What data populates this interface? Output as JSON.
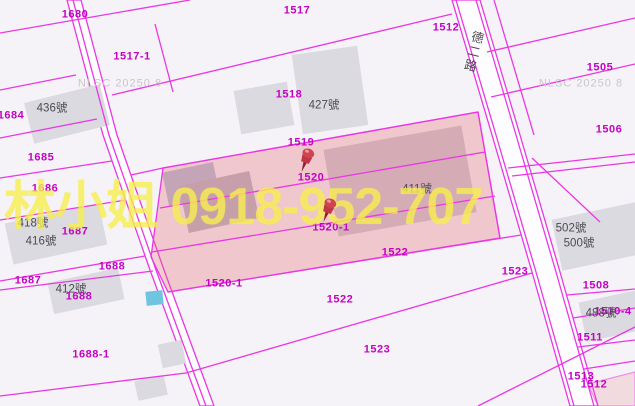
{
  "map": {
    "watermark": {
      "text": "林小姐 0918-952-707",
      "color": "#f8ee50"
    },
    "road_name": {
      "text": "德二路",
      "x": 466,
      "y": 30
    },
    "colors": {
      "background": "#f5f3f7",
      "line": "#ea37e4",
      "road_fill": "#fdfdff",
      "selected_fill": "rgba(228,105,115,0.32)",
      "parcel_label": "#c303c3",
      "building_label": "#4b4b52",
      "building_fill": "#dbdae0",
      "water_fill": "#6fc4e0",
      "pin_red": "#c03744",
      "nlsc_gray": "#cbc5cd",
      "watermark_yellow": "#f8ee50"
    },
    "nlsc_watermarks": [
      {
        "text": "NLSC 20250 8",
        "x": 120,
        "y": 84
      },
      {
        "text": "NLSC 20250 8",
        "x": 581,
        "y": 84
      }
    ],
    "parcel_labels": [
      {
        "text": "1680",
        "x": 75,
        "y": 15
      },
      {
        "text": "1517",
        "x": 297,
        "y": 11
      },
      {
        "text": "1512",
        "x": 446,
        "y": 28
      },
      {
        "text": "1517-1",
        "x": 132,
        "y": 57
      },
      {
        "text": "1505",
        "x": 600,
        "y": 68
      },
      {
        "text": "1518",
        "x": 289,
        "y": 95
      },
      {
        "text": "1684",
        "x": 11,
        "y": 116
      },
      {
        "text": "1506",
        "x": 609,
        "y": 130
      },
      {
        "text": "1519",
        "x": 301,
        "y": 143
      },
      {
        "text": "1685",
        "x": 41,
        "y": 158
      },
      {
        "text": "1520",
        "x": 311,
        "y": 178
      },
      {
        "text": "1686",
        "x": 45,
        "y": 189
      },
      {
        "text": "1520-1",
        "x": 331,
        "y": 228
      },
      {
        "text": "1687",
        "x": 75,
        "y": 232
      },
      {
        "text": "1522",
        "x": 395,
        "y": 253
      },
      {
        "text": "1688",
        "x": 112,
        "y": 267
      },
      {
        "text": "1523",
        "x": 515,
        "y": 272
      },
      {
        "text": "1687",
        "x": 28,
        "y": 281
      },
      {
        "text": "1520-1",
        "x": 224,
        "y": 284
      },
      {
        "text": "1508",
        "x": 596,
        "y": 286
      },
      {
        "text": "1688",
        "x": 79,
        "y": 297
      },
      {
        "text": "1522",
        "x": 340,
        "y": 300
      },
      {
        "text": "1510-4",
        "x": 613,
        "y": 312
      },
      {
        "text": "1511",
        "x": 590,
        "y": 338
      },
      {
        "text": "1523",
        "x": 377,
        "y": 350
      },
      {
        "text": "1688-1",
        "x": 91,
        "y": 355
      },
      {
        "text": "1513",
        "x": 581,
        "y": 377
      },
      {
        "text": "1512",
        "x": 594,
        "y": 385
      }
    ],
    "building_labels": [
      {
        "text": "436號",
        "x": 52,
        "y": 109
      },
      {
        "text": "427號",
        "x": 324,
        "y": 106
      },
      {
        "text": "411號",
        "x": 417,
        "y": 190
      },
      {
        "text": "418號",
        "x": 33,
        "y": 224
      },
      {
        "text": "416號",
        "x": 41,
        "y": 242
      },
      {
        "text": "502號",
        "x": 571,
        "y": 229
      },
      {
        "text": "500號",
        "x": 579,
        "y": 244
      },
      {
        "text": "412號",
        "x": 71,
        "y": 290
      },
      {
        "text": "488號",
        "x": 601,
        "y": 314
      }
    ],
    "pins": [
      {
        "x": 307,
        "y": 157
      },
      {
        "x": 329,
        "y": 207
      }
    ],
    "geometry": {
      "roads": [
        {
          "points": [
            [
              67,
              0
            ],
            [
              81,
              0
            ],
            [
              117,
              135
            ],
            [
              164,
              270
            ],
            [
              214,
              406
            ],
            [
              200,
              406
            ],
            [
              150,
              270
            ],
            [
              103,
              135
            ]
          ]
        },
        {
          "points": [
            [
              452,
              0
            ],
            [
              480,
              0
            ],
            [
              520,
              135
            ],
            [
              560,
              272
            ],
            [
              598,
              406
            ],
            [
              570,
              406
            ],
            [
              532,
              272
            ],
            [
              492,
              135
            ]
          ]
        }
      ],
      "buildings": [
        {
          "x": 28,
          "y": 93,
          "w": 78,
          "h": 42,
          "rot": -14
        },
        {
          "x": 297,
          "y": 50,
          "w": 66,
          "h": 80,
          "rot": -8
        },
        {
          "x": 237,
          "y": 86,
          "w": 54,
          "h": 44,
          "rot": -10
        },
        {
          "x": 8,
          "y": 213,
          "w": 96,
          "h": 42,
          "rot": -12
        },
        {
          "x": 50,
          "y": 275,
          "w": 72,
          "h": 32,
          "rot": -12
        },
        {
          "x": 165,
          "y": 167,
          "w": 52,
          "h": 34,
          "rot": -12,
          "fill": "#b4c1d8"
        },
        {
          "x": 183,
          "y": 178,
          "w": 72,
          "h": 48,
          "rot": -12,
          "fill": "#b9b9c6"
        },
        {
          "x": 330,
          "y": 137,
          "w": 140,
          "h": 88,
          "rot": -10,
          "fill": "#cfccd6"
        },
        {
          "x": 556,
          "y": 210,
          "w": 90,
          "h": 52,
          "rot": -12
        },
        {
          "x": 582,
          "y": 296,
          "w": 60,
          "h": 40,
          "rot": -12
        },
        {
          "x": 160,
          "y": 342,
          "w": 24,
          "h": 24,
          "rot": -12
        },
        {
          "x": 136,
          "y": 378,
          "w": 30,
          "h": 20,
          "rot": -12
        }
      ],
      "water": [
        {
          "x": 146,
          "y": 291,
          "w": 17,
          "h": 14,
          "rot": -6
        }
      ],
      "selected_areas": [
        {
          "points": [
            [
              163,
              168
            ],
            [
              478,
              112
            ],
            [
              500,
              238
            ],
            [
              168,
              292
            ],
            [
              151,
              257
            ]
          ],
          "opacity": 1
        },
        {
          "points": [
            [
              588,
              384
            ],
            [
              635,
              372
            ],
            [
              635,
              406
            ],
            [
              598,
              406
            ]
          ],
          "opacity": 0.55
        }
      ],
      "lines": [
        {
          "points": [
            [
              0,
              33
            ],
            [
              190,
              0
            ]
          ]
        },
        {
          "points": [
            [
              0,
              90
            ],
            [
              76,
              75
            ]
          ]
        },
        {
          "points": [
            [
              0,
              138
            ],
            [
              97,
              119
            ]
          ]
        },
        {
          "points": [
            [
              0,
              178
            ],
            [
              112,
              161
            ]
          ]
        },
        {
          "points": [
            [
              0,
              220
            ],
            [
              126,
              200
            ]
          ]
        },
        {
          "points": [
            [
              0,
              281
            ],
            [
              145,
              256
            ]
          ]
        },
        {
          "points": [
            [
              0,
              290
            ],
            [
              153,
              271
            ]
          ]
        },
        {
          "points": [
            [
              0,
              396
            ],
            [
              186,
              373
            ],
            [
              532,
              273
            ]
          ]
        },
        {
          "points": [
            [
              155,
              24
            ],
            [
              173,
              92
            ]
          ]
        },
        {
          "points": [
            [
              112,
              95
            ],
            [
              452,
              14
            ]
          ]
        },
        {
          "points": [
            [
              131,
              175
            ],
            [
              163,
              168
            ],
            [
              478,
              112
            ]
          ]
        },
        {
          "points": [
            [
              160,
              208
            ],
            [
              485,
              152
            ]
          ]
        },
        {
          "points": [
            [
              152,
              252
            ],
            [
              495,
              196
            ]
          ]
        },
        {
          "points": [
            [
              168,
              292
            ],
            [
              521,
              235
            ]
          ]
        },
        {
          "points": [
            [
              487,
              52
            ],
            [
              635,
              18
            ]
          ]
        },
        {
          "points": [
            [
              491,
              97
            ],
            [
              635,
              64
            ]
          ]
        },
        {
          "points": [
            [
              508,
              168
            ],
            [
              635,
              154
            ]
          ]
        },
        {
          "points": [
            [
              512,
              176
            ],
            [
              635,
              162
            ]
          ]
        },
        {
          "points": [
            [
              532,
              158
            ],
            [
              600,
              222
            ]
          ]
        },
        {
          "points": [
            [
              567,
              295
            ],
            [
              635,
              289
            ]
          ]
        },
        {
          "points": [
            [
              573,
              318
            ],
            [
              635,
              308
            ]
          ]
        },
        {
          "points": [
            [
              578,
              347
            ],
            [
              635,
              340
            ]
          ]
        },
        {
          "points": [
            [
              584,
              369
            ],
            [
              635,
              361
            ]
          ]
        },
        {
          "points": [
            [
              478,
              406
            ],
            [
              635,
              327
            ]
          ]
        },
        {
          "points": [
            [
              73,
              0
            ],
            [
              109,
              135
            ],
            [
              156,
              270
            ],
            [
              206,
              406
            ]
          ]
        },
        {
          "points": [
            [
              456,
              0
            ],
            [
              496,
              135
            ],
            [
              536,
              272
            ],
            [
              574,
              406
            ]
          ]
        },
        {
          "points": [
            [
              476,
              0
            ],
            [
              516,
              135
            ],
            [
              556,
              272
            ],
            [
              594,
              406
            ]
          ]
        },
        {
          "points": [
            [
              494,
              0
            ],
            [
              534,
              135
            ]
          ]
        },
        {
          "points": [
            [
              478,
              112
            ],
            [
              500,
              238
            ]
          ]
        }
      ]
    }
  }
}
